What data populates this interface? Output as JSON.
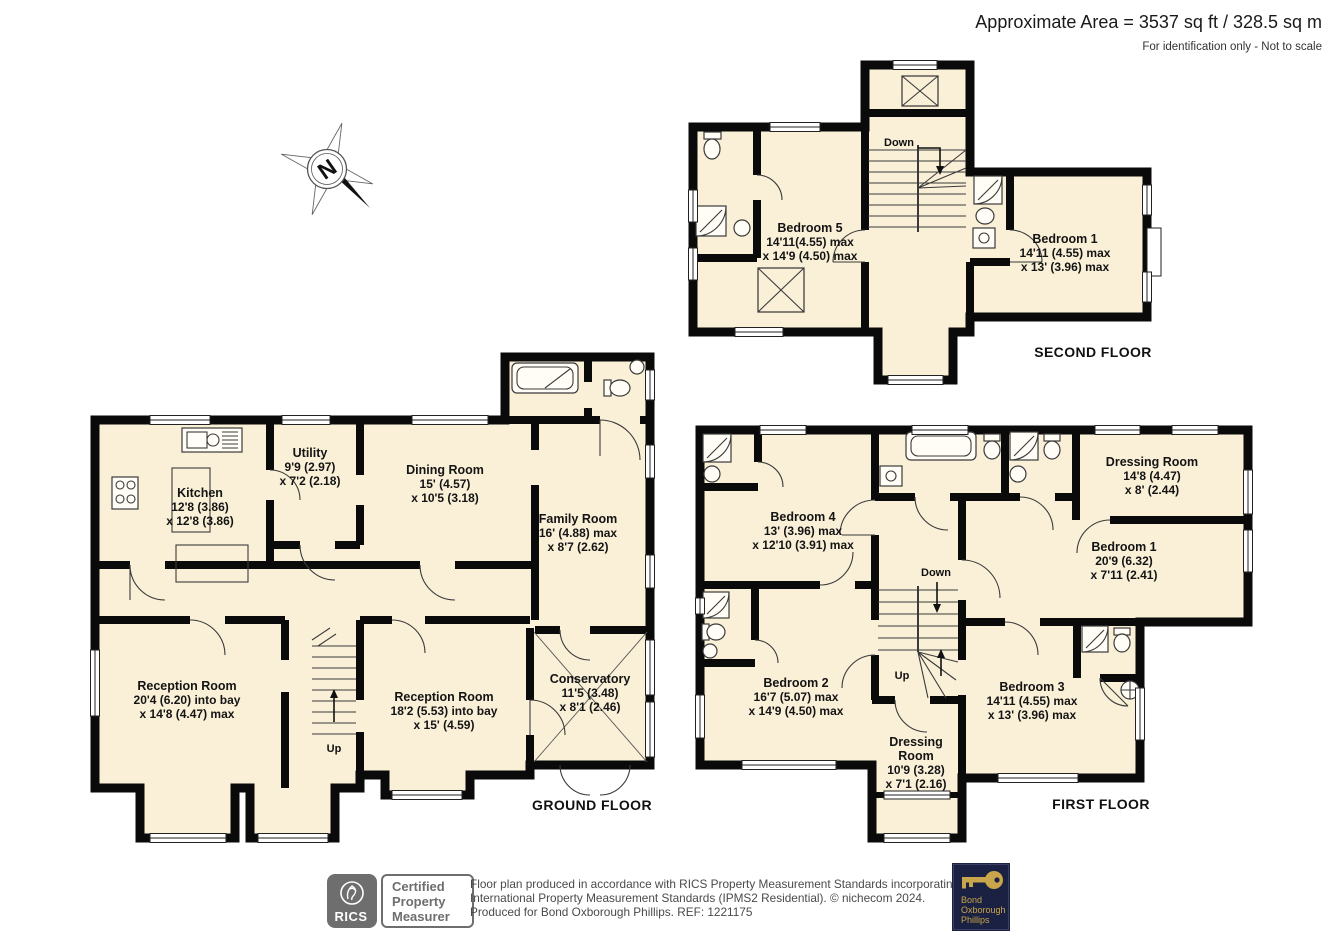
{
  "header": {
    "area": "Approximate Area = 3537 sq ft / 328.5 sq m",
    "note": "For identification only - Not to scale"
  },
  "compass": {
    "letter": "N"
  },
  "colors": {
    "room_fill": "#FAF0D8",
    "wall": "#0a0a0a",
    "rics_gray": "#6E6E6E",
    "brand_navy": "#1B2142",
    "brand_gold": "#C9A54C"
  },
  "floors": {
    "second": {
      "label": "SECOND FLOOR",
      "stairs": "Down",
      "rooms": {
        "bedroom5": {
          "name": "Bedroom 5",
          "dim1": "14'11(4.55) max",
          "dim2": "x 14'9 (4.50) max"
        },
        "bedroom1": {
          "name": "Bedroom 1",
          "dim1": "14'11 (4.55) max",
          "dim2": "x 13' (3.96) max"
        }
      }
    },
    "ground": {
      "label": "GROUND FLOOR",
      "stairs": "Up",
      "rooms": {
        "kitchen": {
          "name": "Kitchen",
          "dim1": "12'8 (3.86)",
          "dim2": "x 12'8 (3.86)"
        },
        "utility": {
          "name": "Utility",
          "dim1": "9'9 (2.97)",
          "dim2": "x 7'2 (2.18)"
        },
        "dining": {
          "name": "Dining Room",
          "dim1": "15' (4.57)",
          "dim2": "x 10'5 (3.18)"
        },
        "family": {
          "name": "Family Room",
          "dim1": "16' (4.88) max",
          "dim2": "x 8'7 (2.62)"
        },
        "reception1": {
          "name": "Reception Room",
          "dim1": "20'4 (6.20) into bay",
          "dim2": "x 14'8 (4.47) max"
        },
        "reception2": {
          "name": "Reception Room",
          "dim1": "18'2 (5.53) into bay",
          "dim2": "x 15' (4.59)"
        },
        "conservatory": {
          "name": "Conservatory",
          "dim1": "11'5 (3.48)",
          "dim2": "x 8'1 (2.46)"
        }
      }
    },
    "first": {
      "label": "FIRST FLOOR",
      "stairs_down": "Down",
      "stairs_up": "Up",
      "rooms": {
        "bedroom4": {
          "name": "Bedroom 4",
          "dim1": "13' (3.96) max",
          "dim2": "x 12'10 (3.91) max"
        },
        "dressing1": {
          "name": "Dressing Room",
          "dim1": "14'8 (4.47)",
          "dim2": "x 8' (2.44)"
        },
        "bedroom1": {
          "name": "Bedroom 1",
          "dim1": "20'9 (6.32)",
          "dim2": "x 7'11 (2.41)"
        },
        "bedroom2": {
          "name": "Bedroom 2",
          "dim1": "16'7 (5.07) max",
          "dim2": "x 14'9 (4.50) max"
        },
        "dressing2": {
          "name1": "Dressing",
          "name2": "Room",
          "dim1": "10'9 (3.28)",
          "dim2": "x 7'1 (2.16)"
        },
        "bedroom3": {
          "name": "Bedroom 3",
          "dim1": "14'11 (4.55) max",
          "dim2": "x 13' (3.96) max"
        }
      }
    }
  },
  "footer": {
    "rics": {
      "name": "RICS",
      "line1": "Certified",
      "line2": "Property",
      "line3": "Measurer"
    },
    "disclaimer": {
      "line1": "Floor plan produced in accordance with RICS Property Measurement Standards incorporating",
      "line2": "International Property Measurement Standards (IPMS2 Residential).   © nichecom 2024.",
      "line3": "Produced for Bond Oxborough Phillips.   REF: 1221175"
    },
    "brand": {
      "line1": "Bond",
      "line2": "Oxborough",
      "line3": "Phillips"
    }
  }
}
